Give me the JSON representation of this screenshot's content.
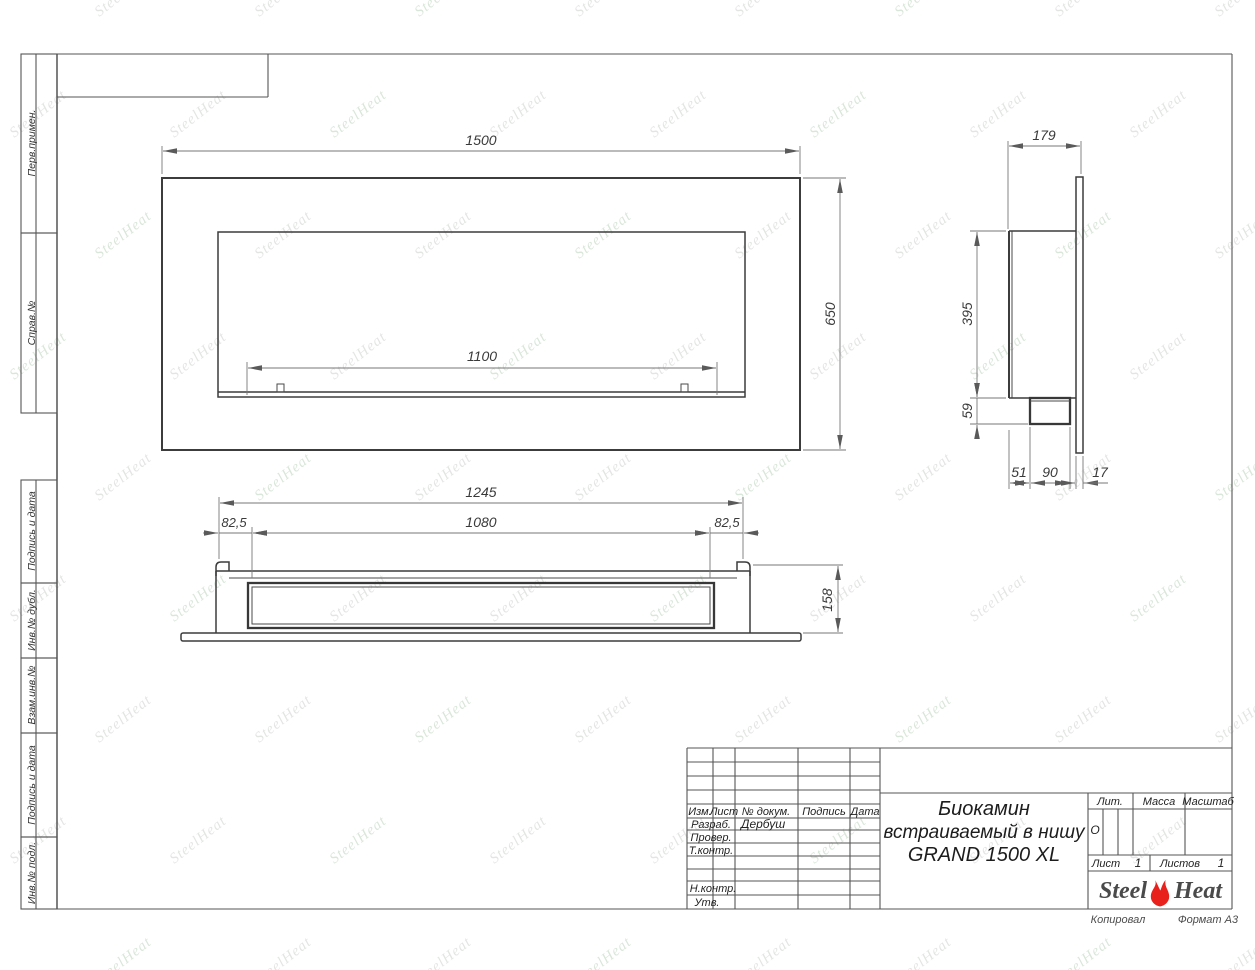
{
  "sheet": {
    "margin_labels": [
      "Перв.примен.",
      "Справ.№",
      "Подпись и дата",
      "Инв.№ дубл.",
      "Взам.инв.№",
      "Подпись и дата",
      "Инв.№ подл."
    ],
    "footer": {
      "copied": "Копировал",
      "format": "Формат А3"
    }
  },
  "views": {
    "front": {
      "width": "1500",
      "height": "650",
      "burner_width": "1100"
    },
    "side": {
      "depth": "179",
      "height": "395",
      "tray_height": "59",
      "offset": "51",
      "tray_depth": "90",
      "flange": "17"
    },
    "plan": {
      "width": "1245",
      "left": "82,5",
      "slot": "1080",
      "right": "82,5",
      "depth": "158"
    }
  },
  "title_block": {
    "rev_cols": {
      "izm": "Изм.",
      "list": "Лист",
      "doc": "№ докум.",
      "sign": "Подпись",
      "date": "Дата"
    },
    "roles": [
      {
        "label": "Разраб.",
        "value": "Дербуш"
      },
      {
        "label": "Провер.",
        "value": ""
      },
      {
        "label": "Т.контр.",
        "value": ""
      },
      {
        "label": "Н.контр.",
        "value": ""
      },
      {
        "label": "Утв.",
        "value": ""
      }
    ],
    "name_lines": [
      "Биокамин",
      "встраиваемый в нишу",
      "GRAND 1500 XL"
    ],
    "lit": {
      "label": "Лит.",
      "value": "О"
    },
    "mass_label": "Масса",
    "scale_label": "Масштаб",
    "sheet_no": {
      "label": "Лист",
      "value": "1"
    },
    "sheets_total": {
      "label": "Листов",
      "value": "1"
    },
    "logo": {
      "steel": "Steel",
      "heat": "Heat"
    },
    "logo_flame_color": "#e8211c"
  },
  "watermark": {
    "text": "SteelHeat",
    "colors": [
      "#c9cdc9",
      "#b7cfb7"
    ]
  }
}
